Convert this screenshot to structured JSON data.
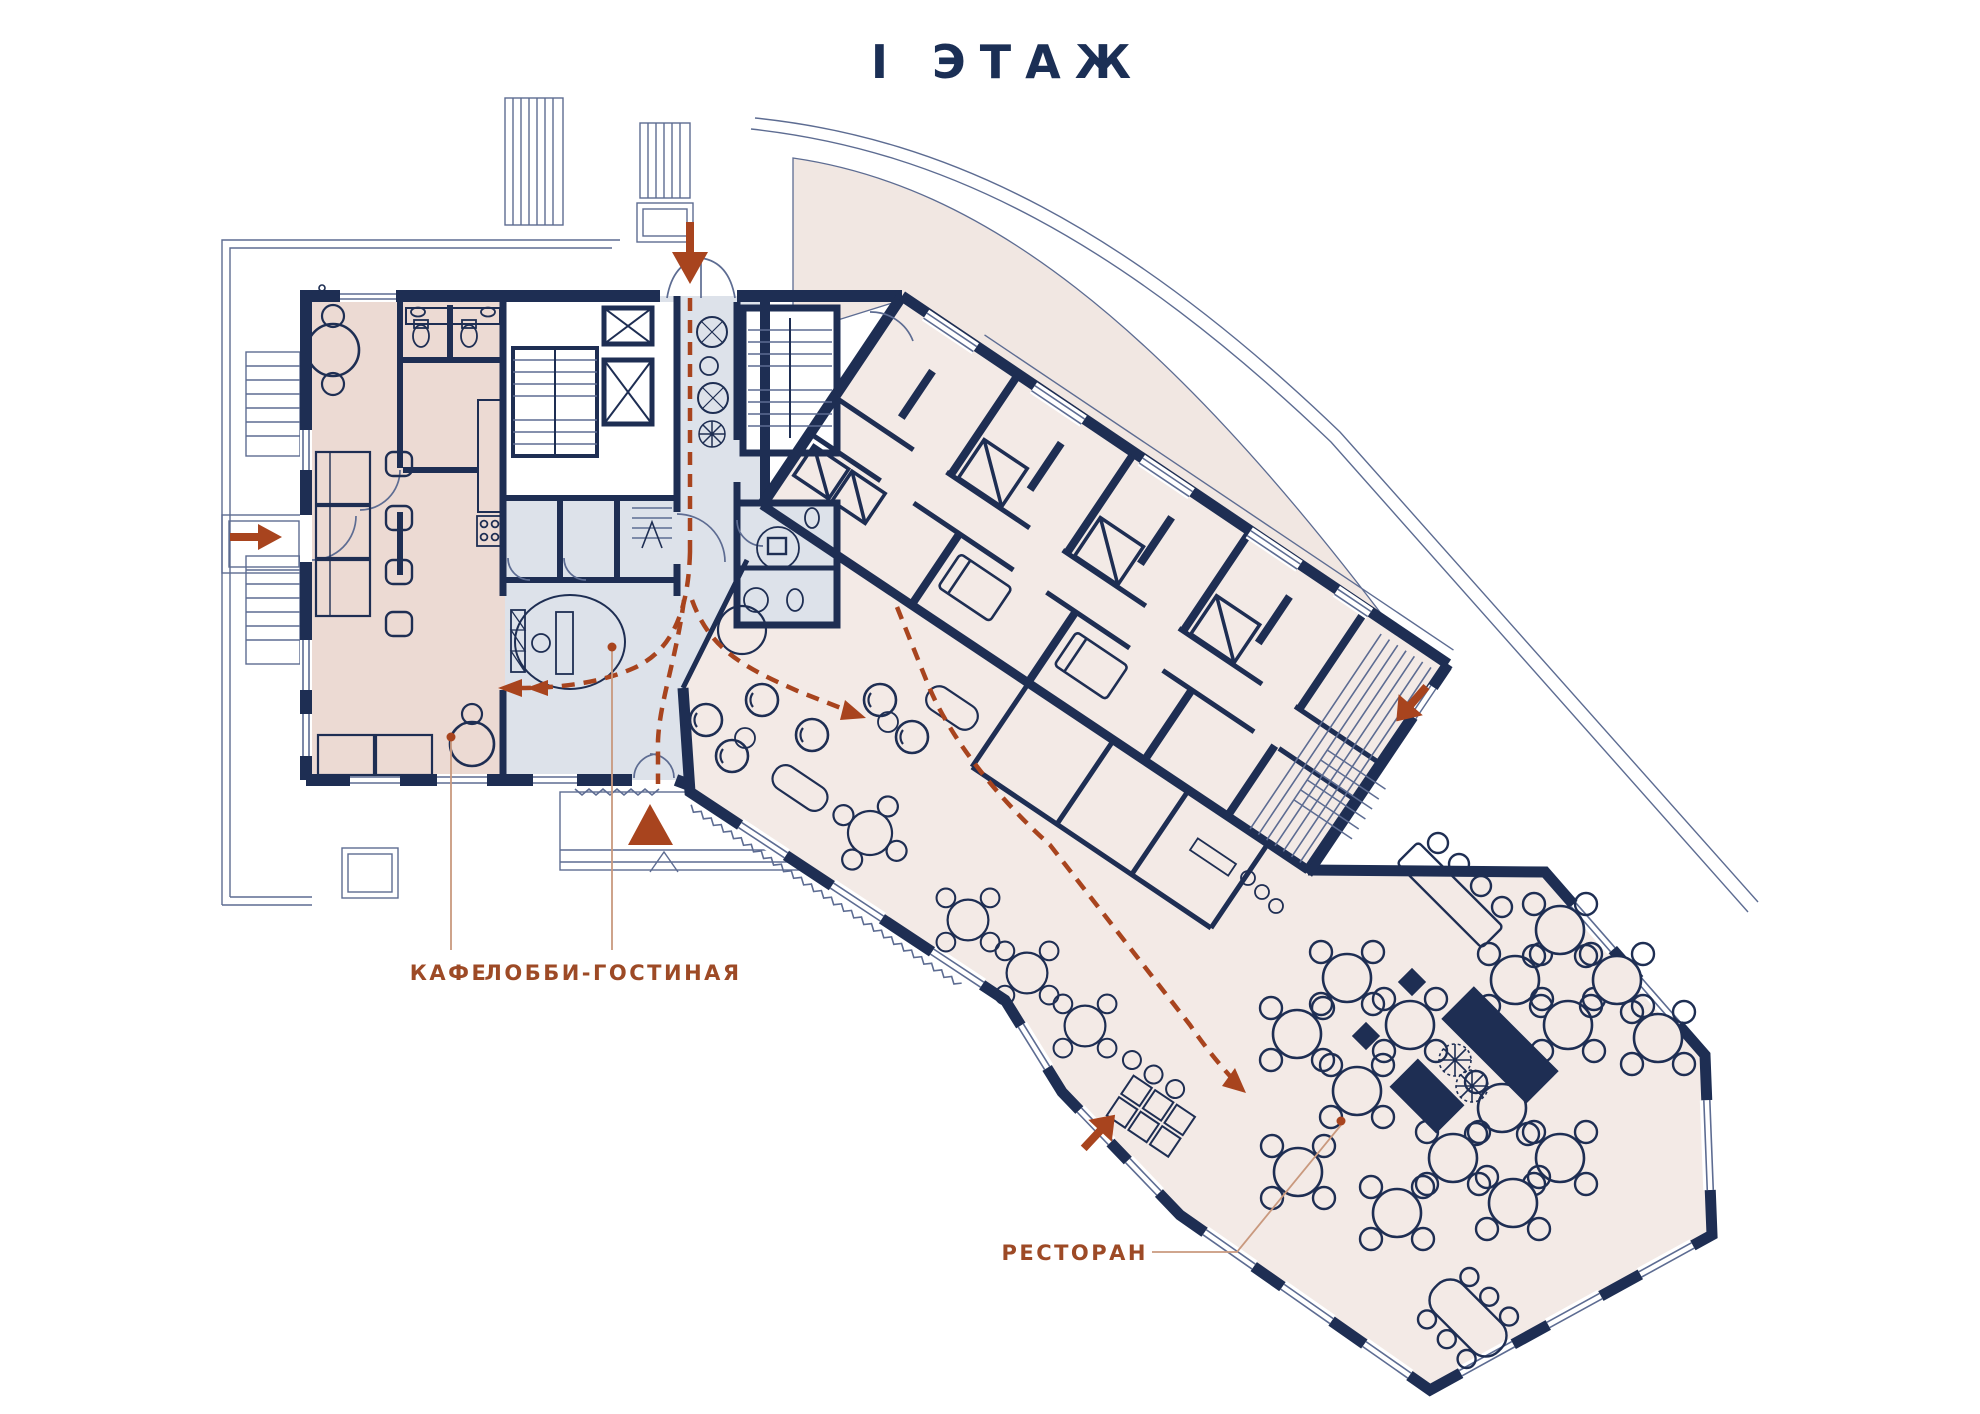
{
  "title": "I ЭТАЖ",
  "labels": {
    "cafe": "КАФЕ",
    "lobby_lounge": "ЛОББИ-ГОСТИНАЯ",
    "restaurant": "РЕСТОРАН"
  },
  "palette": {
    "wall": "#1e2e53",
    "thin_line": "#5d6c92",
    "faint_line": "#8d99b8",
    "cafe_fill": "#ecdad3",
    "lobby_fill": "#dde2ea",
    "rooms_fill": "#f3eae6",
    "terrace_fill": "#f1e7e2",
    "accent_rust": "#a8441e",
    "label_color": "#9d4a26",
    "leader_line": "#c9997e",
    "title_color": "#1b2f55"
  },
  "markers": {
    "main_entrance": "triangle-up-icon",
    "north_entrance": "arrow-down-icon",
    "west_entrance": "arrow-right-icon",
    "east_entrance": "arrow-down-left-icon",
    "restaurant_entrance": "arrow-up-right-icon",
    "circulation": "dashed-path"
  }
}
